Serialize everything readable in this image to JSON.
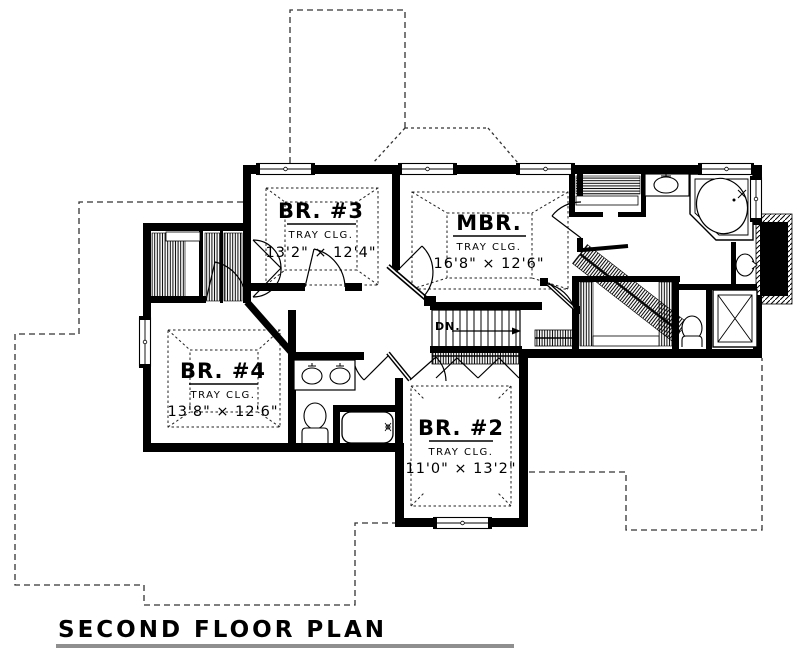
{
  "title": {
    "text": "SECOND FLOOR PLAN"
  },
  "rooms": {
    "br3": {
      "name": "BR. #3",
      "ceiling": "TRAY CLG.",
      "dims": "13'2\" × 12'4\""
    },
    "mbr": {
      "name": "MBR.",
      "ceiling": "TRAY CLG.",
      "dims": "16'8\" × 12'6\""
    },
    "br4": {
      "name": "BR. #4",
      "ceiling": "TRAY CLG.",
      "dims": "13'8\" × 12'6\""
    },
    "br2": {
      "name": "BR. #2",
      "ceiling": "TRAY CLG.",
      "dims": "11'0\" × 13'2\""
    }
  },
  "stairs": {
    "label": "DN."
  },
  "colors": {
    "ink": "#000000",
    "paper": "#ffffff",
    "title_underline": "#8f8f8f"
  }
}
